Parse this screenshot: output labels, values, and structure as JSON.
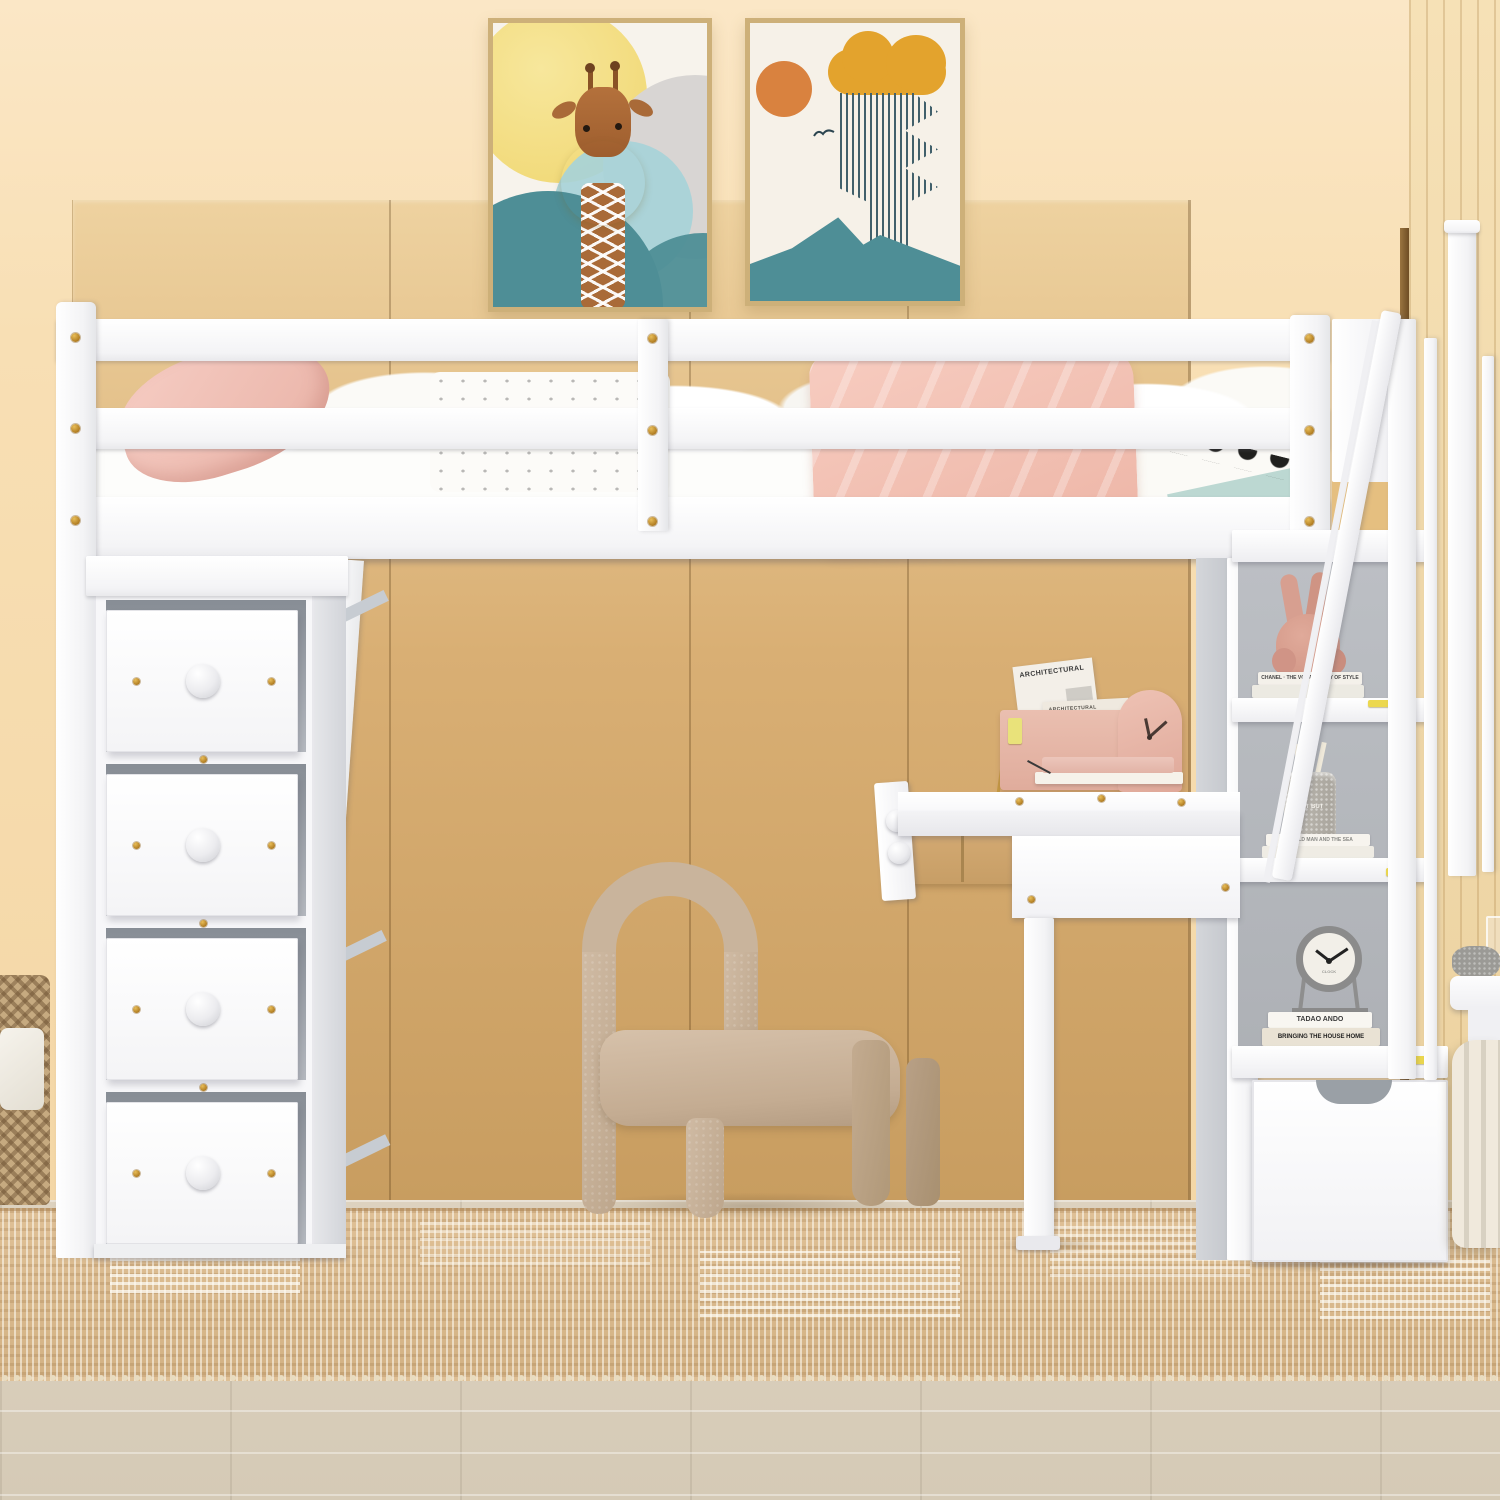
{
  "texts": {
    "magazine_title": "ARCHITECTURAL",
    "magazine_subtitle": "ARCHITECTURAL",
    "pencil_cup_label": "GUT BUT",
    "book_chanel": "CHANEL · THE VOCABULARY OF STYLE",
    "book_old_man": "THE OLD MAN AND THE SEA",
    "book_tadao": "TADAO ANDO",
    "book_bringing": "BRINGING THE HOUSE HOME",
    "clock_face_label": "CLOCK"
  },
  "colors": {
    "wall_peach": "#f8dfb4",
    "wardrobe_tan": "#d9af74",
    "furniture_white": "#ffffff",
    "hardware_gold": "#c9962e",
    "pillow_pink": "#f2c3b8",
    "blanket_pink": "#f3c3b4",
    "chair_beige": "#c9b49c",
    "poster_teal": "#4e8e96",
    "poster_yellow": "#f2da7c",
    "poster_orange": "#d9823f",
    "poster_mustard": "#e3a32d",
    "bunny_pink": "#d89e8e",
    "desk_clock_pink": "#e7b5a7",
    "shelf_back_gray": "#b5b8bc",
    "rug_tan": "#d9bc92",
    "floor_beige": "#d9cfbc",
    "sticker_yellow": "#ecd84e"
  }
}
